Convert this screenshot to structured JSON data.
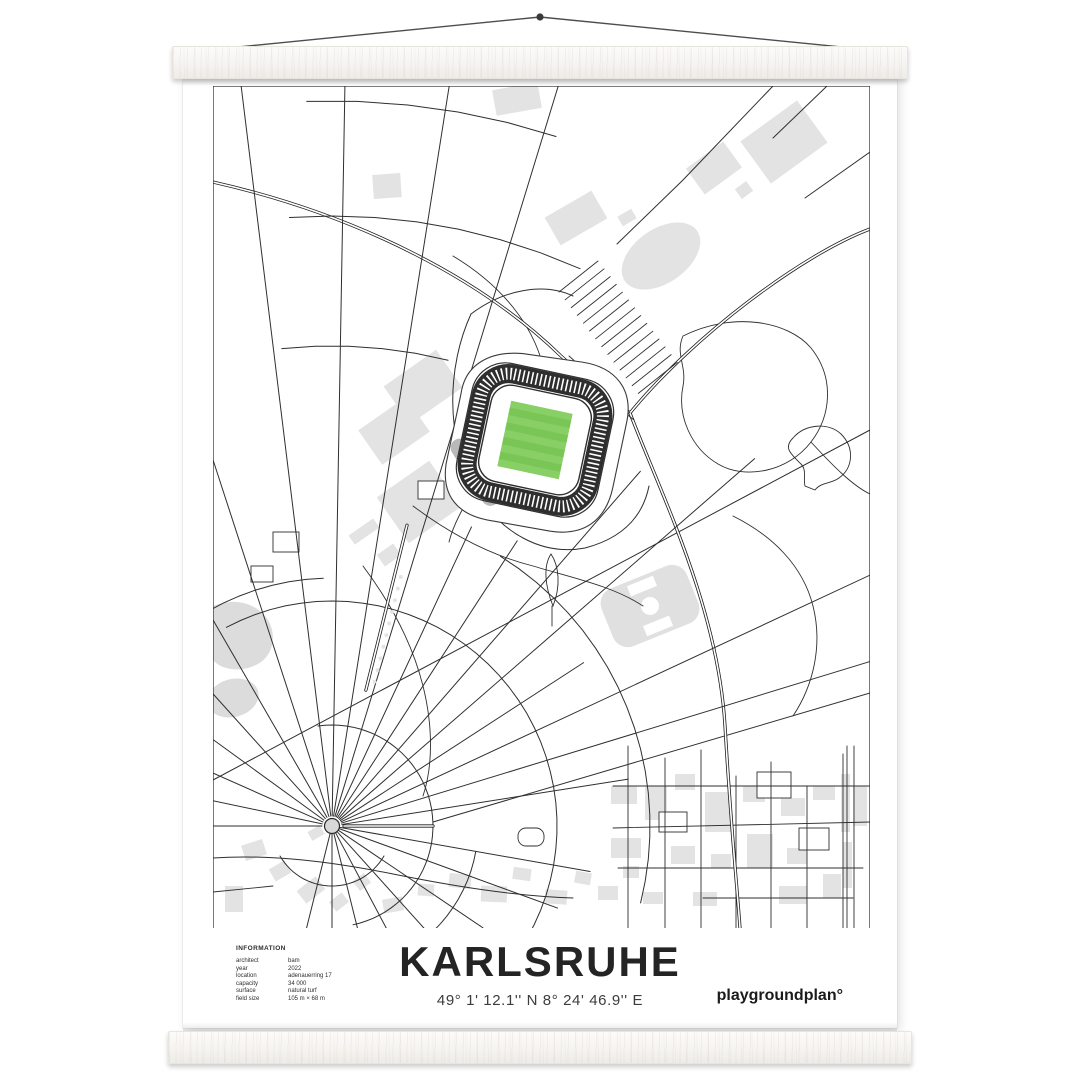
{
  "poster": {
    "title": "KARLSRUHE",
    "coordinates": "49° 1' 12.1'' N  8° 24' 46.9'' E",
    "brand": "playgroundplan°",
    "information": {
      "heading": "INFORMATION",
      "rows": [
        {
          "label": "architect",
          "value": "bam"
        },
        {
          "label": "year",
          "value": "2022"
        },
        {
          "label": "location",
          "value": "adenauerring 17"
        },
        {
          "label": "capacity",
          "value": "34 000"
        },
        {
          "label": "surface",
          "value": "natural turf"
        },
        {
          "label": "field size",
          "value": "105 m × 68 m"
        }
      ]
    }
  },
  "map": {
    "colors": {
      "line": "#2f2f2f",
      "building": "#e3e3e3",
      "stand_dark": "#2e2e2e",
      "pitch_green": "#79c556",
      "pitch_stripe": "#88d065",
      "old_stand_gray": "#b9b9b9"
    }
  }
}
